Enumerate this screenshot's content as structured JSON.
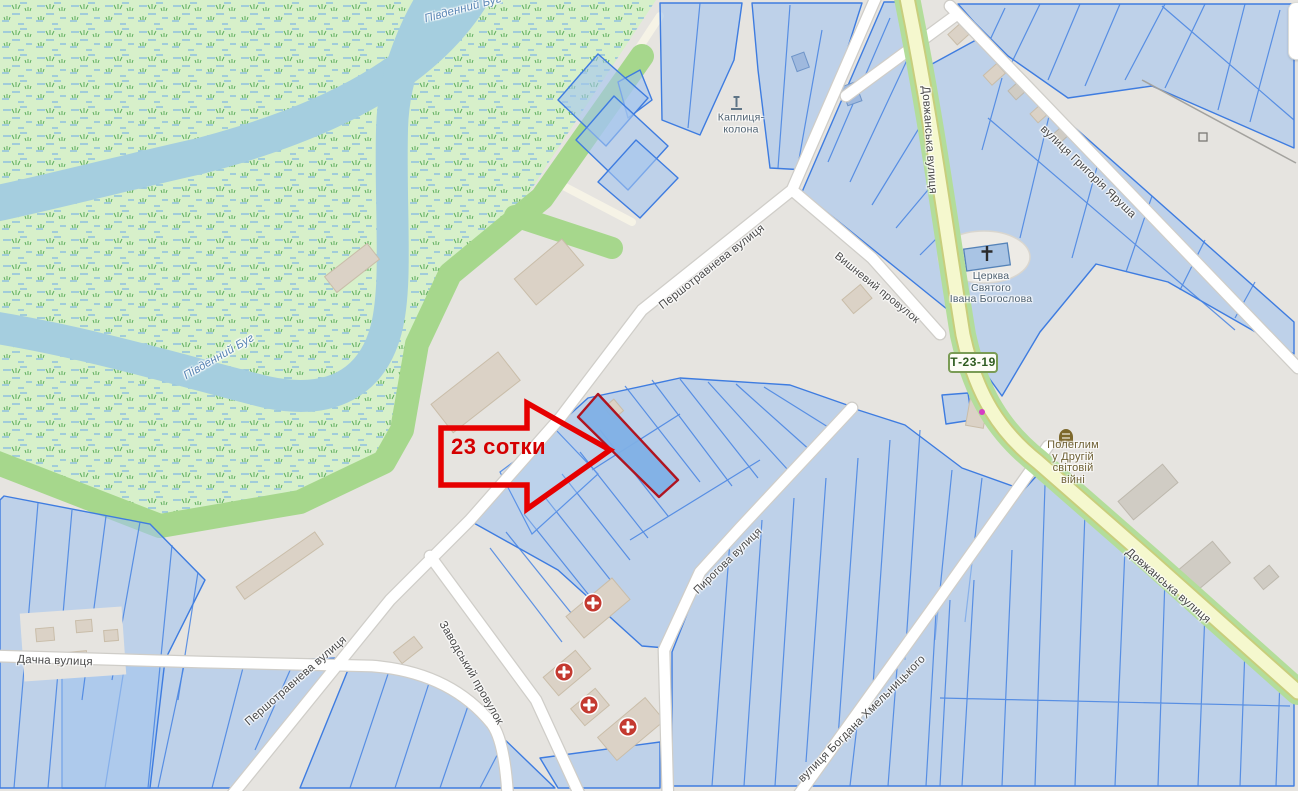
{
  "map": {
    "streets": {
      "pershotravneva": "Першотравнева вулиця",
      "dachna": "Дачна вулиця",
      "zavodskyi": "Заводський провулок",
      "pyrohova": "Пирогова вулиця",
      "bohdana_khmelnytskoho": "вулиця Богдана Хмельницького",
      "hryhoriia_yarusha": "вулиця Григорія Яруша",
      "dovzhanska": "Довжанська вулиця",
      "vyshnevyi": "Вишневий провулок"
    },
    "river": {
      "name": "Південний Буг"
    },
    "road_shield": {
      "ref": "Т-23-19"
    },
    "annotation": {
      "label": "23 сотки"
    },
    "pois": {
      "chapel": {
        "line1": "Каплиця-",
        "line2": "колона"
      },
      "church": {
        "line1": "Церква",
        "line2": "Святого",
        "line3": "Івана Богослова"
      },
      "memorial": {
        "line1": "Полеглим",
        "line2": "у Другій",
        "line3": "світовій",
        "line4": "війні"
      }
    },
    "colors": {
      "background": "#E6E4E0",
      "parcel_fill": "#A4C4EF",
      "parcel_stroke": "#3E7CE0",
      "highlight_parcel_stroke": "#AF1420",
      "annotation_red": "#D40000",
      "water": "#A5CEDF",
      "marsh": "#D7F0CA",
      "scrub": "#A6D78C",
      "road_yellow_fill": "#F5F8CE",
      "medical_marker": "#C43A30"
    }
  }
}
